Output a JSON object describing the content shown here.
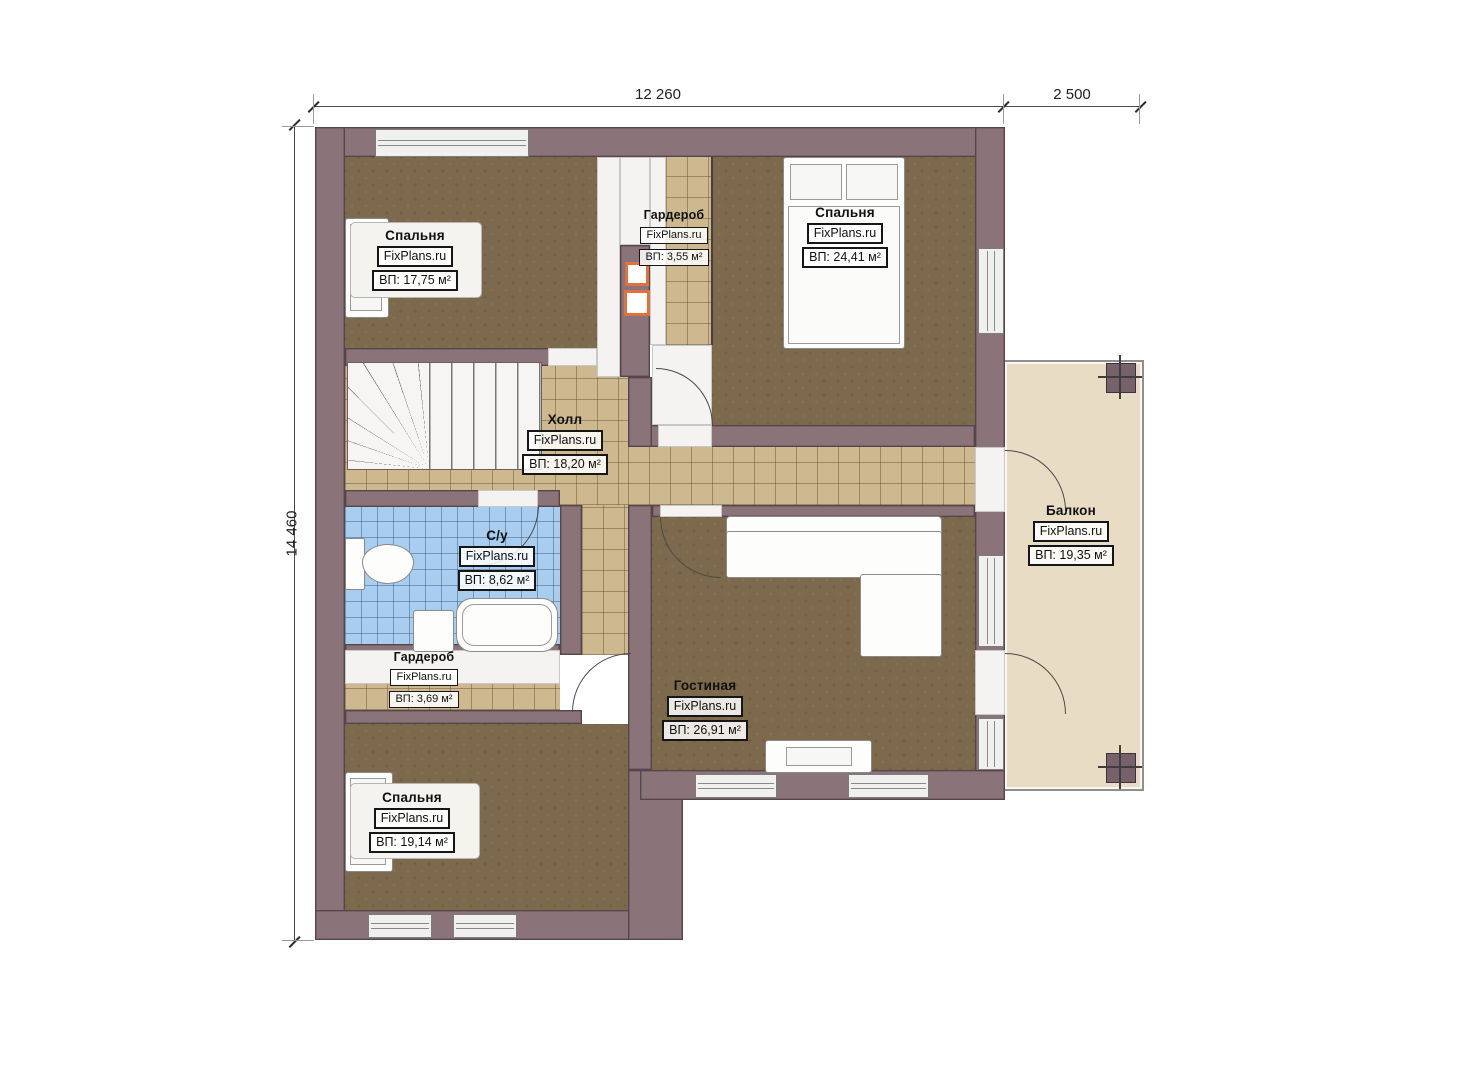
{
  "brand": "FixPlans.ru",
  "dimensions": {
    "width_main": "12 260",
    "width_balcony": "2 500",
    "height": "14 460"
  },
  "rooms": [
    {
      "id": "bedroom-top-left",
      "name": "Спальня",
      "brand": "FixPlans.ru",
      "area": "ВП: 17,75 м²"
    },
    {
      "id": "wardrobe-top",
      "name": "Гардероб",
      "brand": "FixPlans.ru",
      "area": "ВП: 3,55 м²"
    },
    {
      "id": "bedroom-top-right",
      "name": "Спальня",
      "brand": "FixPlans.ru",
      "area": "ВП: 24,41 м²"
    },
    {
      "id": "hall",
      "name": "Холл",
      "brand": "FixPlans.ru",
      "area": "ВП: 18,20 м²"
    },
    {
      "id": "bathroom",
      "name": "С/у",
      "brand": "FixPlans.ru",
      "area": "ВП: 8,62 м²"
    },
    {
      "id": "wardrobe-lower",
      "name": "Гардероб",
      "brand": "FixPlans.ru",
      "area": "ВП: 3,69 м²"
    },
    {
      "id": "bedroom-bottom",
      "name": "Спальня",
      "brand": "FixPlans.ru",
      "area": "ВП: 19,14 м²"
    },
    {
      "id": "living-room",
      "name": "Гостиная",
      "brand": "FixPlans.ru",
      "area": "ВП: 26,91 м²"
    },
    {
      "id": "balcony",
      "name": "Балкон",
      "brand": "FixPlans.ru",
      "area": "ВП: 19,35 м²"
    }
  ],
  "colors": {
    "wall": "#8b737a",
    "carpet": "#7d694b",
    "tile_hall": "#cdb88f",
    "tile_bath": "#a9cdef",
    "balcony_floor": "#e9dcc5",
    "vent_accent": "#e0713d"
  }
}
